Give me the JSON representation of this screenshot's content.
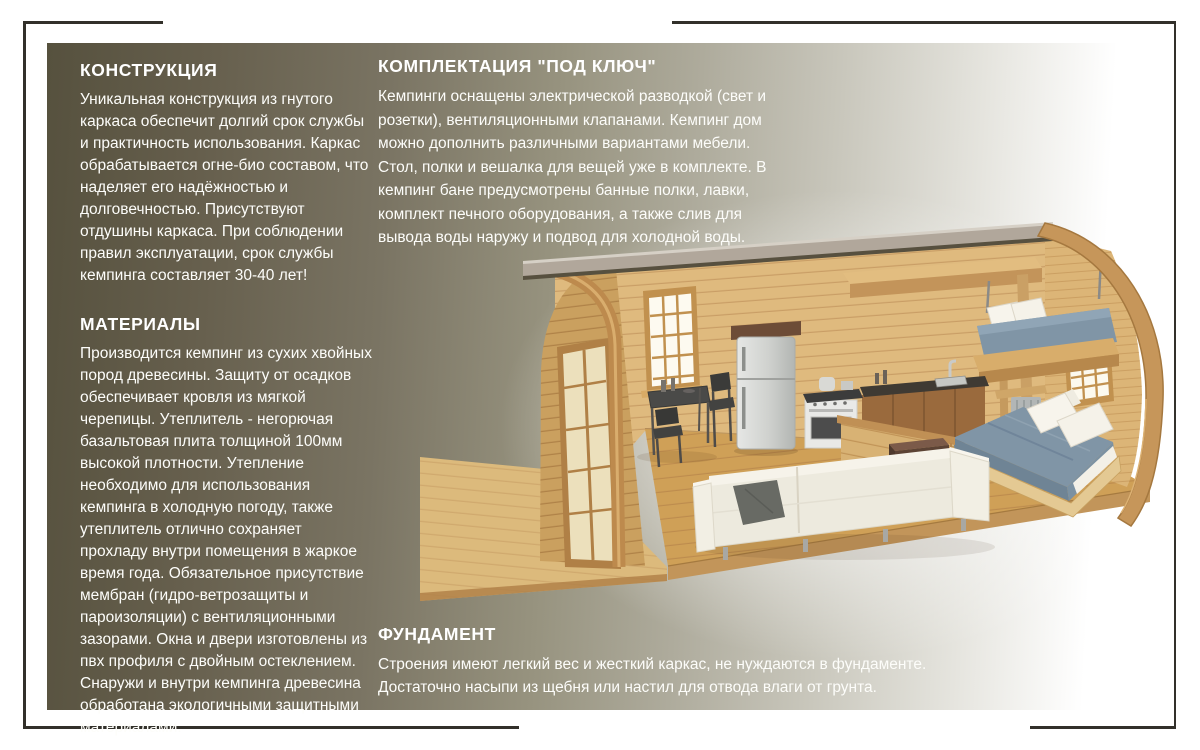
{
  "page": {
    "background": "#ffffff",
    "frame_color": "#32302a",
    "panel_gradient_start": "#56513e",
    "panel_gradient_end": "#ffffff",
    "text_color": "#ffffff"
  },
  "sections": {
    "construction": {
      "title": "КОНСТРУКЦИЯ",
      "body": "Уникальная конструкция из гнутого каркаса обеспечит долгий срок службы и практичность использования. Каркас обрабатывается огне-био составом, что наделяет его надёжностью и долговечностью. Присутствуют отдушины каркаса. При соблюдении правил эксплуатации, срок службы кемпинга составляет 30-40 лет!"
    },
    "materials": {
      "title": "МАТЕРИАЛЫ",
      "body": "Производится кемпинг из сухих хвойных пород древесины. Защиту от осадков обеспечивает кровля из мягкой черепицы.  Утеплитель - негорючая базальтовая плита толщиной 100мм высокой плотности. Утепление необходимо для использования кемпинга в холодную погоду, также утеплитель отлично сохраняет прохладу внутри помещения в жаркое время года. Обязательное присутствие мембран (гидро-ветрозащиты и пароизоляции) с вентиляционными зазорами. Окна и двери изготовлены из пвх профиля с двойным остеклением. Снаружи и внутри кемпинга древесина обработана экологичными  защитными материалами."
    },
    "turnkey": {
      "title": "КОМПЛЕКТАЦИЯ \"ПОД КЛЮЧ\"",
      "body": "Кемпинги оснащены электрической разводкой (свет и розетки), вентиляционными клапанами. Кемпинг дом можно дополнить различными вариантами мебели. Стол, полки и вешалка для вещей уже в комплекте. В кемпинг бане предусмотрены банные полки, лавки, комплект печного оборудования, а также слив для вывода воды наружу и подвод для холодной воды."
    },
    "foundation": {
      "title": "ФУНДАМЕНТ",
      "body": "Строения имеют легкий вес и жесткий каркас, не нуждаются в фундаменте. Достаточно насыпи из щебня или настил для отвода влаги от грунта."
    }
  },
  "illustration": {
    "name": "camping-house-cutaway",
    "description": "3D cutaway render of a barrel-roof wooden camping house: deck, glazed door, kitchen with fridge and stove, dining table, white sofa, double bed and loft bed with blue bedding",
    "colors": {
      "wood_light": "#ddbc7e",
      "wood_mid": "#cfa158",
      "wood_dark": "#b98a4e",
      "roof_grey": "#b1a79b",
      "bedding_blue": "#8095a6",
      "sofa_ivory": "#edeade",
      "steel": "#c9c9c7"
    }
  }
}
